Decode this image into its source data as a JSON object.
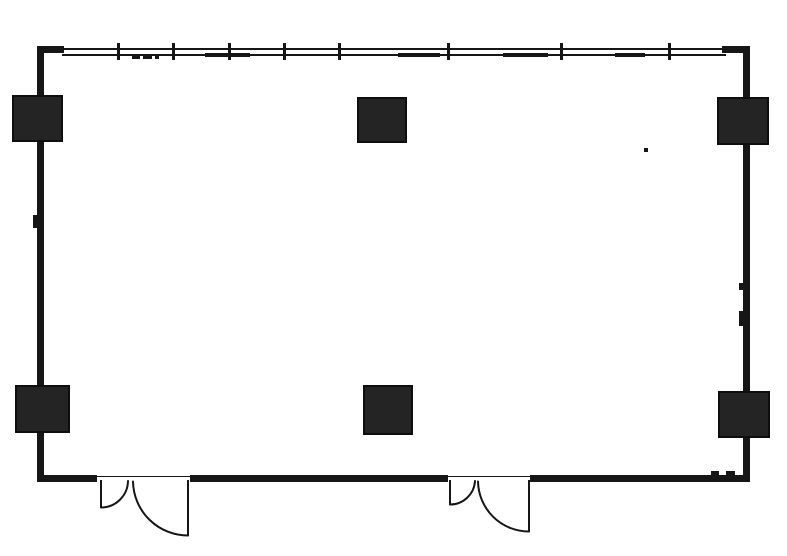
{
  "canvas": {
    "w": 787,
    "h": 556,
    "bg": "#ffffff",
    "ink": "#161616",
    "column_fill": "#242424"
  },
  "plan": {
    "walls": [
      {
        "name": "left-wall",
        "x": 37,
        "y": 46,
        "w": 7,
        "h": 436
      },
      {
        "name": "right-wall",
        "x": 743,
        "y": 46,
        "w": 7,
        "h": 436
      },
      {
        "name": "top-wall-left-stub",
        "x": 37,
        "y": 46,
        "w": 27,
        "h": 7
      },
      {
        "name": "top-wall-right-stub",
        "x": 722,
        "y": 46,
        "w": 28,
        "h": 7
      },
      {
        "name": "bottom-wall-left-segment",
        "x": 37,
        "y": 475,
        "w": 60,
        "h": 7
      },
      {
        "name": "bottom-wall-middle-segment",
        "x": 190,
        "y": 475,
        "w": 258,
        "h": 7
      },
      {
        "name": "bottom-wall-right-segment",
        "x": 530,
        "y": 475,
        "w": 220,
        "h": 7
      }
    ],
    "window": {
      "x1": 62,
      "x2": 726,
      "upper_y": 48,
      "lower_y": 54,
      "line_h": 2,
      "ticks": {
        "xs": [
          117,
          172,
          228,
          283,
          338,
          447,
          560,
          668
        ],
        "y": 43,
        "h": 17,
        "w": 2.5
      },
      "heavy_y": 53,
      "heavy_h": 3.5,
      "heavy_segments": [
        {
          "x1": 205,
          "x2": 250
        },
        {
          "x1": 398,
          "x2": 440
        },
        {
          "x1": 503,
          "x2": 548
        },
        {
          "x1": 615,
          "x2": 645
        }
      ]
    },
    "columns": [
      {
        "name": "column-top-left",
        "x": 12,
        "y": 95,
        "w": 51,
        "h": 47
      },
      {
        "name": "column-top-middle",
        "x": 357,
        "y": 97,
        "w": 50,
        "h": 46
      },
      {
        "name": "column-top-right",
        "x": 717,
        "y": 97,
        "w": 52,
        "h": 48
      },
      {
        "name": "column-bottom-left",
        "x": 15,
        "y": 385,
        "w": 55,
        "h": 48
      },
      {
        "name": "column-bottom-middle",
        "x": 363,
        "y": 385,
        "w": 50,
        "h": 50
      },
      {
        "name": "column-bottom-right",
        "x": 718,
        "y": 391,
        "w": 52,
        "h": 47
      }
    ],
    "doors": [
      {
        "name": "left-double-door",
        "threshold": {
          "x1": 97,
          "x2": 190,
          "y": 475.5,
          "h": 1.5
        },
        "leaves": [
          {
            "panel": {
              "x": 101,
              "y1": 480,
              "y2": 508,
              "w": 2.5
            },
            "arc": {
              "sx": 101,
              "sy": 507.5,
              "ex": 128,
              "ey": 481,
              "r": 27
            }
          },
          {
            "panel": {
              "x": 188,
              "y1": 480,
              "y2": 536,
              "w": 2.5
            },
            "arc": {
              "sx": 133,
              "sy": 481.5,
              "ex": 188,
              "ey": 535.5,
              "r": 55
            }
          }
        ]
      },
      {
        "name": "right-double-door",
        "threshold": {
          "x1": 448,
          "x2": 530,
          "y": 475.5,
          "h": 1.5
        },
        "leaves": [
          {
            "panel": {
              "x": 450,
              "y1": 480,
              "y2": 505,
              "w": 2.5
            },
            "arc": {
              "sx": 450,
              "sy": 504.5,
              "ex": 475,
              "ey": 481,
              "r": 25
            }
          },
          {
            "panel": {
              "x": 529,
              "y1": 480,
              "y2": 532,
              "w": 2.5
            },
            "arc": {
              "sx": 478,
              "sy": 481.5,
              "ex": 529,
              "ey": 531.5,
              "r": 51
            }
          }
        ]
      }
    ],
    "artifacts": [
      {
        "name": "window-sill-dash-1",
        "x": 132,
        "y": 56,
        "w": 8,
        "h": 3
      },
      {
        "name": "window-sill-dash-2",
        "x": 143,
        "y": 56,
        "w": 9,
        "h": 3
      },
      {
        "name": "window-sill-dash-3",
        "x": 155,
        "y": 56,
        "w": 4,
        "h": 3
      },
      {
        "name": "left-wall-notch",
        "x": 33,
        "y": 215,
        "w": 5,
        "h": 13
      },
      {
        "name": "right-wall-notch-1",
        "x": 739,
        "y": 283,
        "w": 5,
        "h": 7
      },
      {
        "name": "right-wall-notch-2",
        "x": 739,
        "y": 311,
        "w": 5,
        "h": 15
      },
      {
        "name": "bottom-wall-bump-1",
        "x": 711,
        "y": 471,
        "w": 8,
        "h": 5
      },
      {
        "name": "bottom-wall-bump-2",
        "x": 726,
        "y": 471,
        "w": 9,
        "h": 5
      },
      {
        "name": "ink-speck",
        "x": 644,
        "y": 148,
        "w": 4,
        "h": 4
      }
    ]
  }
}
